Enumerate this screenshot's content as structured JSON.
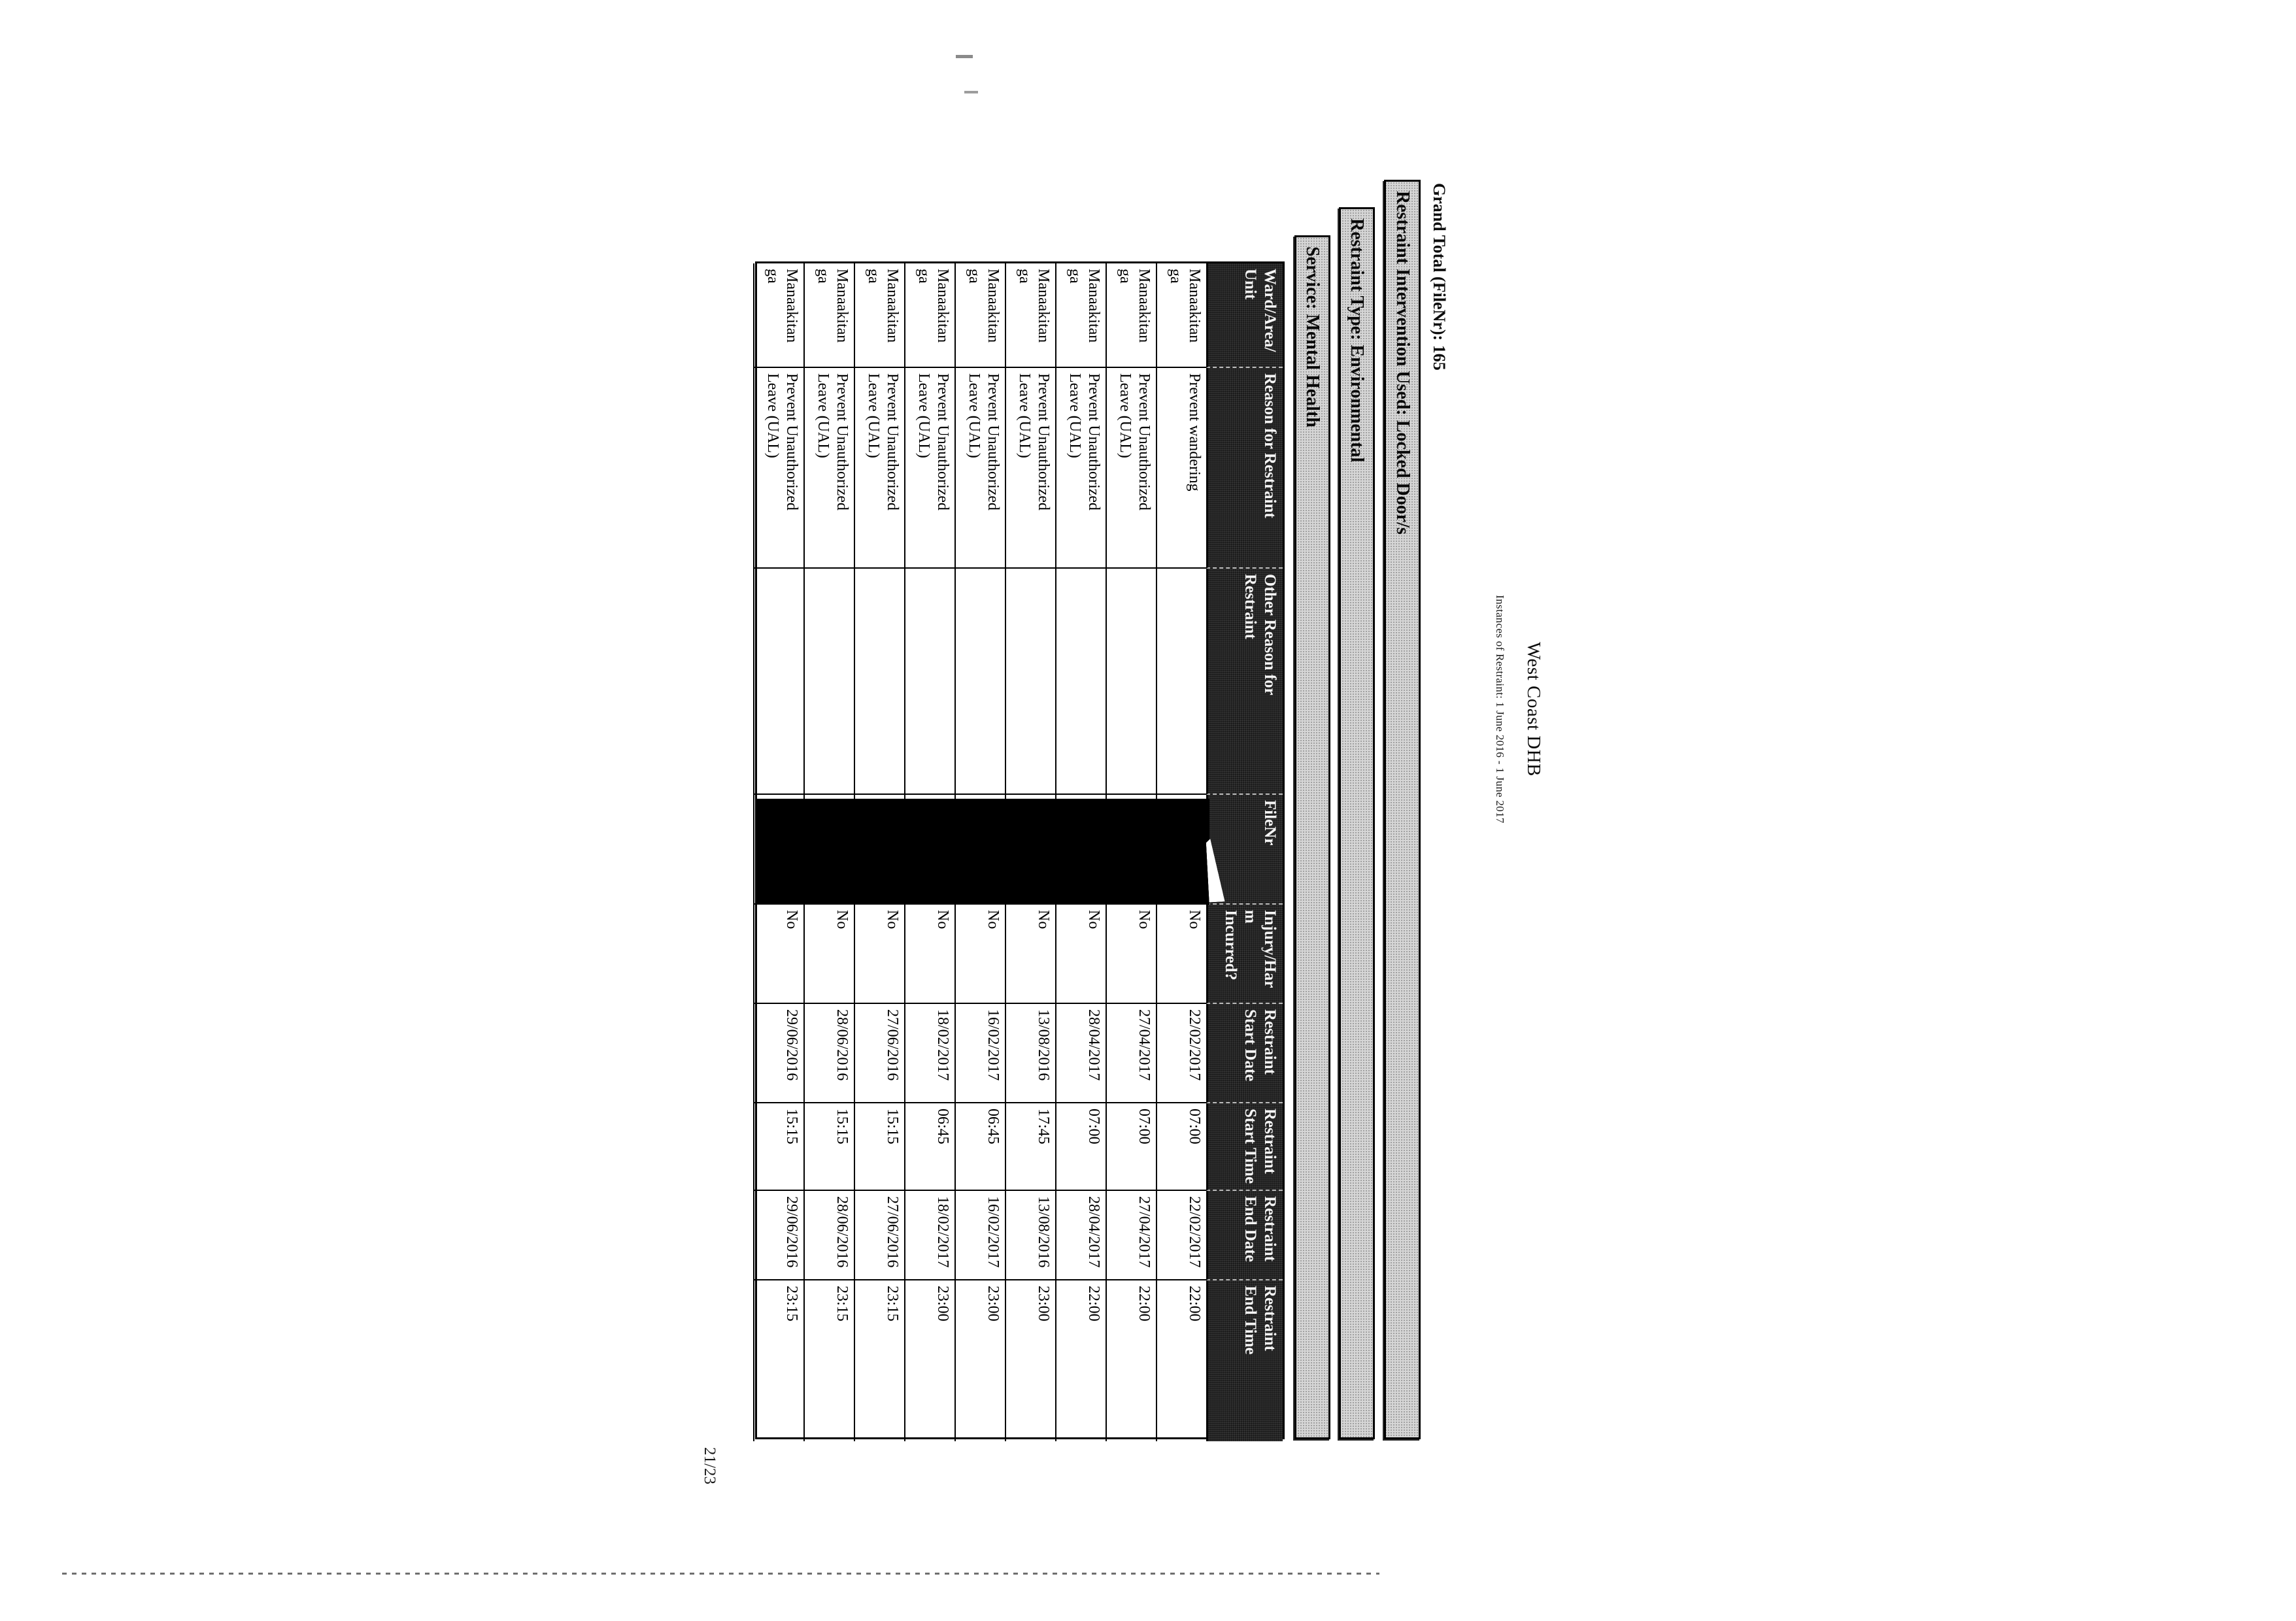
{
  "document": {
    "title": "West Coast DHB",
    "subtitle": "Instances of Restraint: 1 June 2016 -  1 June 2017",
    "grand_total": "Grand Total (FileNr): 165",
    "group_headers": [
      "Restraint Intervention Used: Locked Door/s",
      "Restraint Type: Environmental",
      "Service: Mental Health"
    ],
    "page_number": "21/23"
  },
  "table": {
    "columns": [
      {
        "key": "ward",
        "label": "Ward/Area/\nUnit"
      },
      {
        "key": "reason",
        "label": "Reason for Restraint"
      },
      {
        "key": "other_reason",
        "label": "Other Reason for\nRestraint"
      },
      {
        "key": "file_nr",
        "label": "FileNr"
      },
      {
        "key": "injury",
        "label": "Injury/Har\nm\nIncurred?"
      },
      {
        "key": "start_date",
        "label": "Restraint\nStart Date"
      },
      {
        "key": "start_time",
        "label": "Restraint\nStart Time"
      },
      {
        "key": "end_date",
        "label": "Restraint\nEnd Date"
      },
      {
        "key": "end_time",
        "label": "Restraint\nEnd Time"
      }
    ],
    "redaction_note": "FileNr values for all rows are covered by a black redaction block",
    "rows": [
      {
        "ward": "Manaakitan\nga",
        "reason": "Prevent wandering",
        "other_reason": "",
        "file_nr": "",
        "injury": "No",
        "start_date": "22/02/2017",
        "start_time": "07:00",
        "end_date": "22/02/2017",
        "end_time": "22:00"
      },
      {
        "ward": "Manaakitan\nga",
        "reason": "Prevent Unauthorized\nLeave (UAL)",
        "other_reason": "",
        "file_nr": "",
        "injury": "No",
        "start_date": "27/04/2017",
        "start_time": "07:00",
        "end_date": "27/04/2017",
        "end_time": "22:00"
      },
      {
        "ward": "Manaakitan\nga",
        "reason": "Prevent Unauthorized\nLeave (UAL)",
        "other_reason": "",
        "file_nr": "",
        "injury": "No",
        "start_date": "28/04/2017",
        "start_time": "07:00",
        "end_date": "28/04/2017",
        "end_time": "22:00"
      },
      {
        "ward": "Manaakitan\nga",
        "reason": "Prevent Unauthorized\nLeave (UAL)",
        "other_reason": "",
        "file_nr": "",
        "injury": "No",
        "start_date": "13/08/2016",
        "start_time": "17:45",
        "end_date": "13/08/2016",
        "end_time": "23:00"
      },
      {
        "ward": "Manaakitan\nga",
        "reason": "Prevent Unauthorized\nLeave (UAL)",
        "other_reason": "",
        "file_nr": "",
        "injury": "No",
        "start_date": "16/02/2017",
        "start_time": "06:45",
        "end_date": "16/02/2017",
        "end_time": "23:00"
      },
      {
        "ward": "Manaakitan\nga",
        "reason": "Prevent Unauthorized\nLeave (UAL)",
        "other_reason": "",
        "file_nr": "",
        "injury": "No",
        "start_date": "18/02/2017",
        "start_time": "06:45",
        "end_date": "18/02/2017",
        "end_time": "23:00"
      },
      {
        "ward": "Manaakitan\nga",
        "reason": "Prevent Unauthorized\nLeave (UAL)",
        "other_reason": "",
        "file_nr": "",
        "injury": "No",
        "start_date": "27/06/2016",
        "start_time": "15:15",
        "end_date": "27/06/2016",
        "end_time": "23:15"
      },
      {
        "ward": "Manaakitan\nga",
        "reason": "Prevent Unauthorized\nLeave (UAL)",
        "other_reason": "",
        "file_nr": "",
        "injury": "No",
        "start_date": "28/06/2016",
        "start_time": "15:15",
        "end_date": "28/06/2016",
        "end_time": "23:15"
      },
      {
        "ward": "Manaakitan\nga",
        "reason": "Prevent Unauthorized\nLeave (UAL)",
        "other_reason": "",
        "file_nr": "",
        "injury": "No",
        "start_date": "29/06/2016",
        "start_time": "15:15",
        "end_date": "29/06/2016",
        "end_time": "23:15"
      }
    ]
  }
}
